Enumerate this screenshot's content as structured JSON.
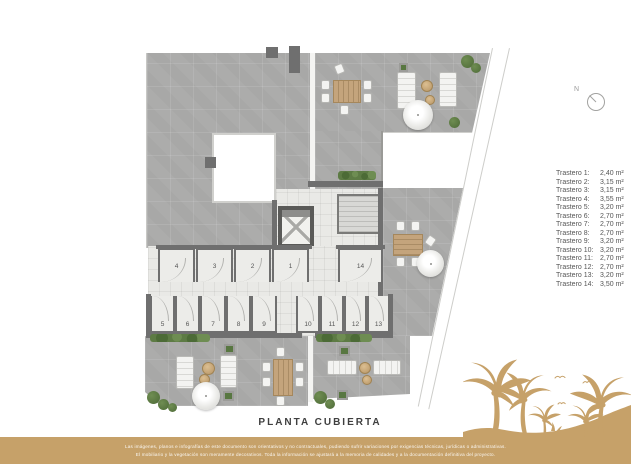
{
  "title": "PLANTA CUBIERTA",
  "north": {
    "label": "N"
  },
  "legend": {
    "items": [
      {
        "label": "Trastero 1:",
        "value": "2,40 m²"
      },
      {
        "label": "Trastero 2:",
        "value": "3,15 m²"
      },
      {
        "label": "Trastero 3:",
        "value": "3,15 m²"
      },
      {
        "label": "Trastero 4:",
        "value": "3,55 m²"
      },
      {
        "label": "Trastero 5:",
        "value": "3,20 m²"
      },
      {
        "label": "Trastero 6:",
        "value": "2,70 m²"
      },
      {
        "label": "Trastero 7:",
        "value": "2,70 m²"
      },
      {
        "label": "Trastero 8:",
        "value": "2,70 m²"
      },
      {
        "label": "Trastero 9:",
        "value": "3,20 m²"
      },
      {
        "label": "Trastero 10:",
        "value": "3,20 m²"
      },
      {
        "label": "Trastero 11:",
        "value": "2,70 m²"
      },
      {
        "label": "Trastero 12:",
        "value": "2,70 m²"
      },
      {
        "label": "Trastero 13:",
        "value": "3,20 m²"
      },
      {
        "label": "Trastero 14:",
        "value": "3,50 m²"
      }
    ]
  },
  "plan": {
    "room_numbers": [
      "1",
      "2",
      "3",
      "4",
      "5",
      "6",
      "7",
      "8",
      "9",
      "10",
      "11",
      "12",
      "13",
      "14"
    ]
  },
  "footer": {
    "line1": "Las imágenes, planos e infografías de este documento son orientativos y no contractuales, pudiendo sufrir variaciones por exigencias técnicas, jurídicas o administrativas.",
    "line2": "El mobiliario y la vegetación son meramente decorativos. Toda la información se ajustará a la memoria de calidades y a la documentación definitiva del proyecto."
  },
  "colors": {
    "brand_gold": "#C6A169",
    "roof_gray": "#ACACAB",
    "floor_light": "#E9E9E6",
    "wall_dark": "#6F6F6F",
    "plant_green": "#5D7B44"
  }
}
